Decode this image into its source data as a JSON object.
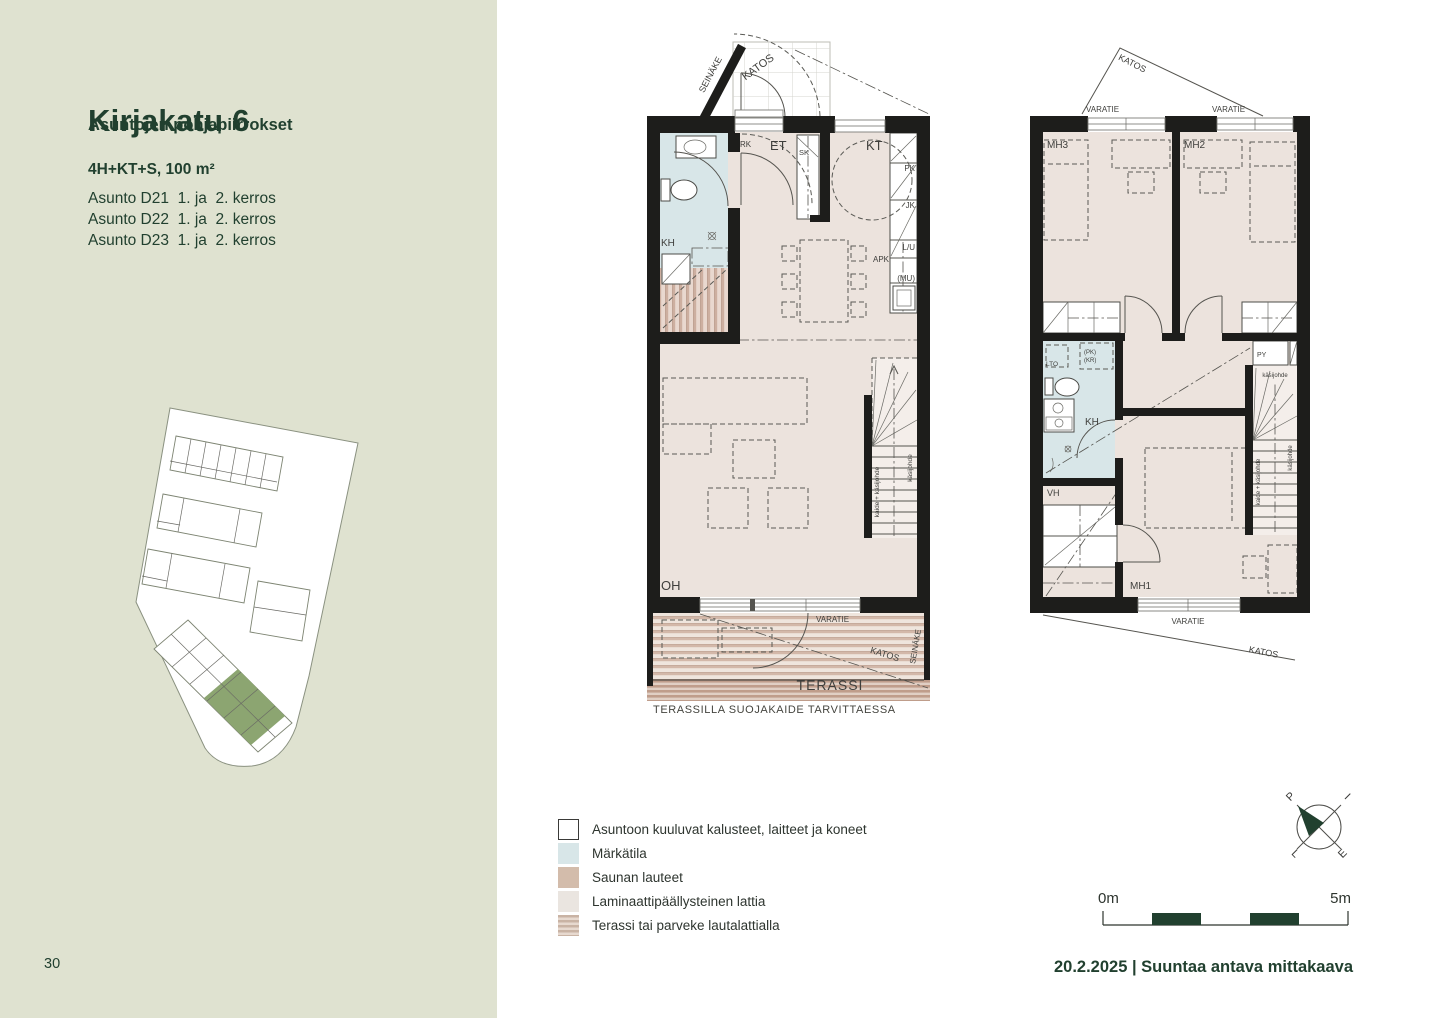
{
  "page": {
    "number": "30",
    "date_line": "20.2.2025 | Suuntaa antava mittakaava"
  },
  "sidebar": {
    "title": "Kirjakatu 6",
    "subtitle": "Asuntojen pohjapiirrokset",
    "apartment_type": "4H+KT+S, 100 m²",
    "apartments": [
      "Asunto D21  1. ja  2. kerros",
      "Asunto D22  1. ja  2. kerros",
      "Asunto D23  1. ja  2. kerros"
    ]
  },
  "legend": {
    "items": [
      {
        "label": "Asuntoon kuuluvat kalusteet, laitteet ja koneet"
      },
      {
        "label": "Märkätila"
      },
      {
        "label": "Saunan lauteet"
      },
      {
        "label": "Laminaattipäällysteinen lattia"
      },
      {
        "label": "Terassi tai parveke lautalattialla"
      }
    ]
  },
  "scalebar": {
    "start": "0m",
    "end": "5m"
  },
  "compass": {
    "n": "P",
    "e": "I",
    "s": "E",
    "w": "L"
  },
  "plan1": {
    "labels": {
      "seinake_top": "SEINÄKE",
      "katos_top": "KATOS",
      "rk": "RK",
      "et": "ET",
      "sk": "SK",
      "kt": "KT",
      "pk": "PK",
      "jk": "JK",
      "lu": "L/U",
      "apk": "APK",
      "mu": "(MU)",
      "kh": "KH",
      "oh": "OH",
      "kaide": "kaide + käsijohde",
      "kasijohde": "käsijohde",
      "varatie": "VARATIE",
      "terassi": "TERASSI",
      "katos_bottom": "KATOS",
      "seinake_bottom": "SEINÄKE"
    },
    "caption": "TERASSILLA SUOJAKAIDE TARVITTAESSA"
  },
  "plan2": {
    "labels": {
      "katos_top": "KATOS",
      "varatie_nw": "VARATIE",
      "varatie_ne": "VARATIE",
      "mh3": "MH3",
      "mh2": "MH2",
      "mh1": "MH1",
      "lto": "LTO",
      "pk": "(PK)",
      "kr": "(KR)",
      "kh": "KH",
      "vh": "VH",
      "py": "PY",
      "kaide": "kaide + käsijohde",
      "kasijohde_rot": "käsijohde",
      "kasijohde_top": "käsijohde",
      "varatie_s": "VARATIE",
      "katos_s": "KATOS"
    }
  },
  "colors": {
    "sidebar_bg": "#dfe2d0",
    "accent": "#21402f",
    "text_dark": "#2e352f",
    "wall": "#1d1d1b",
    "laminate": "#ece3dd",
    "wet": "#d8e6e8",
    "sauna_stripe": "#cdafa0",
    "terrace_dark": "#c9ab9b",
    "site_green": "#8ca571"
  }
}
